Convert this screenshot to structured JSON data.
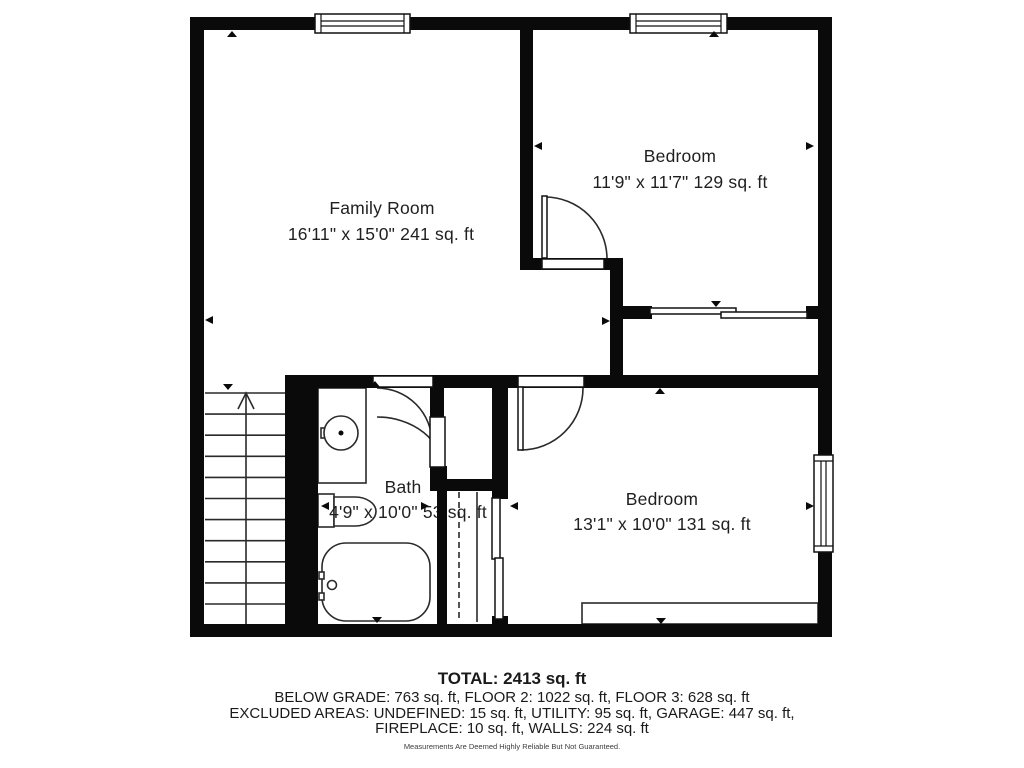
{
  "plan": {
    "rooms": [
      {
        "name": "Family Room",
        "dims": "16'11\" x 15'0\" 241 sq. ft"
      },
      {
        "name": "Bedroom",
        "dims": "11'9\" x 11'7\" 129 sq. ft"
      },
      {
        "name": "Bath",
        "dims": "4'9\" x 10'0\" 53 sq. ft"
      },
      {
        "name": "Bedroom",
        "dims": "13'1\" x 10'0\" 131 sq. ft"
      }
    ],
    "features": [
      "stairs-up",
      "windows",
      "hinged-doors",
      "sliding-closet-doors",
      "bath-sink",
      "toilet",
      "bathtub",
      "closet-rod",
      "built-in-closet"
    ]
  },
  "summary": {
    "total": "TOTAL: 2413 sq. ft",
    "breakdown": "BELOW GRADE: 763 sq. ft, FLOOR 2: 1022 sq. ft, FLOOR 3: 628 sq. ft",
    "excluded_line1": "EXCLUDED AREAS: UNDEFINED: 15 sq. ft, UTILITY: 95 sq. ft, GARAGE: 447 sq. ft,",
    "excluded_line2": "FIREPLACE: 10 sq. ft, WALLS: 224 sq. ft",
    "disclaimer": "Measurements Are Deemed Highly Reliable But Not Guaranteed."
  },
  "colors": {
    "wall": "#0a0a0a",
    "line": "#2a2a2a",
    "text": "#1f1f1f",
    "background": "#ffffff"
  }
}
